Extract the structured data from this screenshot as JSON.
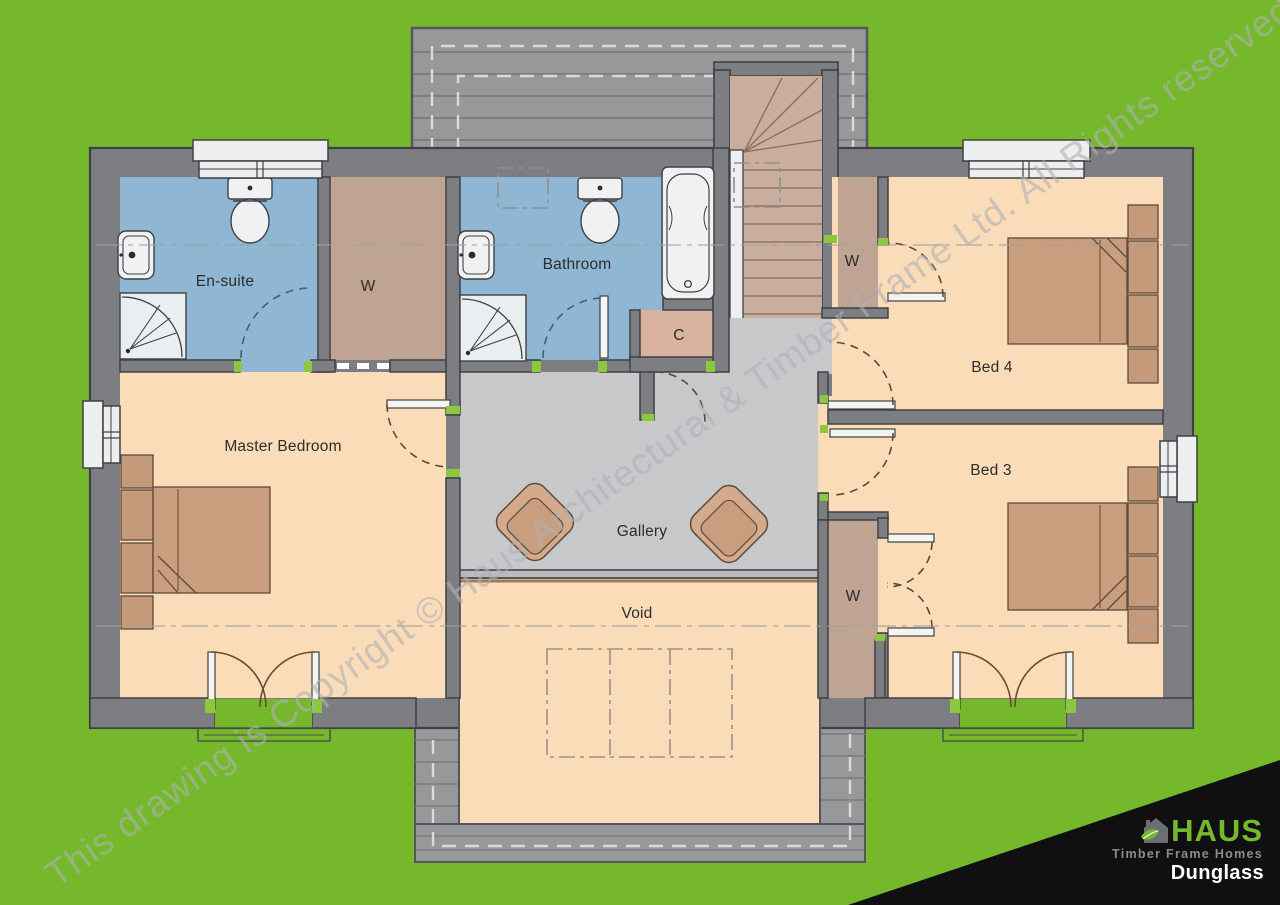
{
  "watermark": {
    "text": "This drawing is Copyright © Haus Architectural & Timber Frame Ltd. All Rights reserved"
  },
  "rooms": {
    "ensuite": {
      "label": "En-suite"
    },
    "wardrobe1": {
      "label": "W"
    },
    "bathroom": {
      "label": "Bathroom"
    },
    "cupboard": {
      "label": "C"
    },
    "master": {
      "label": "Master Bedroom"
    },
    "gallery": {
      "label": "Gallery"
    },
    "void": {
      "label": "Void"
    },
    "bed4": {
      "label": "Bed 4"
    },
    "bed3": {
      "label": "Bed 3"
    },
    "wardrobe_bed4": {
      "label": "W"
    },
    "wardrobe_bed3": {
      "label": "W"
    }
  },
  "logo": {
    "brand": "HAUS",
    "tagline": "Timber Frame Homes",
    "plan_name": "Dunglass"
  },
  "colors": {
    "background_green": "#76B82B",
    "wall_gray": "#7C7E82",
    "floor_peach": "#FBDCB8",
    "wet_room_blue": "#8FB6D2",
    "gallery_gray": "#C6C8CA",
    "wardrobe_tan": "#BFA393",
    "stairs_tan": "#C9AE9E",
    "cupboard_tan": "#D9B2A0",
    "roof_gray": "#96989A",
    "furniture_tan": "#C99E7E",
    "opening_marker_green": "#8DC63F",
    "logo_black": "#101012"
  }
}
